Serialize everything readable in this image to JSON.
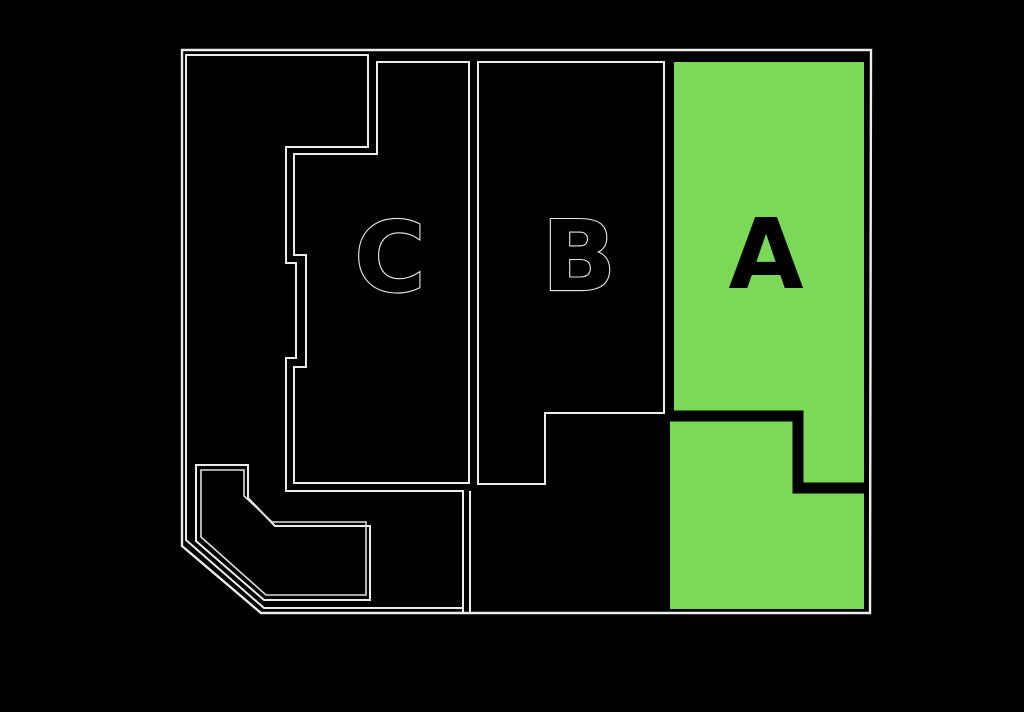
{
  "canvas": {
    "width": 1024,
    "height": 712,
    "background": "#000000"
  },
  "colors": {
    "background": "#000000",
    "line": "#ececec",
    "highlight": "#7bd957",
    "divider": "#000000",
    "label_fill": "#000000",
    "label_outline": "#e6e6e6"
  },
  "labels": [
    {
      "id": "section-c-label",
      "text": "C",
      "x": 390,
      "y": 291,
      "fontSize": 97,
      "fill": "#000000",
      "stroke": "#e6e6e6",
      "strokeWidth": 2.2
    },
    {
      "id": "section-b-label",
      "text": "B",
      "x": 579,
      "y": 290,
      "fontSize": 97,
      "fill": "#000000",
      "stroke": "#e6e6e6",
      "strokeWidth": 2.2
    },
    {
      "id": "section-a-label",
      "text": "A",
      "x": 766,
      "y": 288,
      "fontSize": 97,
      "fill": "#000000",
      "stroke": "none",
      "strokeWidth": 0
    }
  ],
  "shapes": [
    {
      "name": "section-a-highlight",
      "type": "polygon",
      "interactable": true,
      "points": [
        [
          674,
          62
        ],
        [
          864,
          62
        ],
        [
          864,
          609
        ],
        [
          670,
          609
        ],
        [
          670,
          418
        ],
        [
          674,
          418
        ]
      ],
      "fill": "#7bd957",
      "stroke": "none",
      "strokeWidth": 0
    },
    {
      "name": "section-a-divider-band",
      "type": "polyline",
      "interactable": false,
      "points": [
        [
          663,
          416
        ],
        [
          798,
          416
        ],
        [
          798,
          488
        ],
        [
          867,
          488
        ]
      ],
      "fill": "none",
      "stroke": "#000000",
      "strokeWidth": 11
    },
    {
      "name": "outer-boundary",
      "type": "polygon",
      "interactable": false,
      "points": [
        [
          182,
          50
        ],
        [
          871,
          50
        ],
        [
          870,
          613
        ],
        [
          261,
          613
        ],
        [
          182,
          546
        ]
      ],
      "fill": "none",
      "stroke": "#ececec",
      "strokeWidth": 2.4
    },
    {
      "name": "left-parcel-outline",
      "type": "polygon",
      "interactable": false,
      "points": [
        [
          186,
          55
        ],
        [
          368,
          55
        ],
        [
          368,
          147
        ],
        [
          286,
          147
        ],
        [
          286,
          263
        ],
        [
          296,
          263
        ],
        [
          296,
          358
        ],
        [
          286,
          358
        ],
        [
          286,
          491
        ],
        [
          463,
          491
        ],
        [
          463,
          608
        ],
        [
          264,
          608
        ],
        [
          186,
          540
        ]
      ],
      "fill": "none",
      "stroke": "#ececec",
      "strokeWidth": 2
    },
    {
      "name": "section-c-outline",
      "type": "polygon",
      "interactable": true,
      "points": [
        [
          377,
          62
        ],
        [
          469,
          62
        ],
        [
          469,
          483
        ],
        [
          294,
          483
        ],
        [
          294,
          367
        ],
        [
          306,
          367
        ],
        [
          306,
          255
        ],
        [
          294,
          255
        ],
        [
          294,
          154
        ],
        [
          377,
          154
        ]
      ],
      "fill": "none",
      "stroke": "#ececec",
      "strokeWidth": 2
    },
    {
      "name": "section-b-outline",
      "type": "polygon",
      "interactable": true,
      "points": [
        [
          478,
          62
        ],
        [
          664,
          62
        ],
        [
          664,
          413
        ],
        [
          545,
          413
        ],
        [
          545,
          484
        ],
        [
          478,
          484
        ]
      ],
      "fill": "none",
      "stroke": "#ececec",
      "strokeWidth": 2
    },
    {
      "name": "banner-parcel-outer-outline",
      "type": "polygon",
      "interactable": false,
      "points": [
        [
          196,
          465
        ],
        [
          248,
          465
        ],
        [
          248,
          498
        ],
        [
          275,
          526
        ],
        [
          370,
          526
        ],
        [
          370,
          600
        ],
        [
          264,
          600
        ],
        [
          196,
          541
        ]
      ],
      "fill": "none",
      "stroke": "#ececec",
      "strokeWidth": 2
    },
    {
      "name": "banner-parcel-inner-outline",
      "type": "polygon",
      "interactable": false,
      "points": [
        [
          201,
          470
        ],
        [
          244,
          470
        ],
        [
          244,
          496
        ],
        [
          272,
          522
        ],
        [
          366,
          522
        ],
        [
          366,
          595
        ],
        [
          266,
          595
        ],
        [
          201,
          537
        ]
      ],
      "fill": "none",
      "stroke": "#dedede",
      "strokeWidth": 1.6
    },
    {
      "name": "bottom-strip-divider-left",
      "type": "polyline",
      "interactable": false,
      "points": [
        [
          463,
          608
        ],
        [
          463,
          613
        ]
      ],
      "fill": "none",
      "stroke": "#ececec",
      "strokeWidth": 2
    },
    {
      "name": "bottom-strip-divider-right",
      "type": "polyline",
      "interactable": false,
      "points": [
        [
          470,
          491
        ],
        [
          470,
          613
        ]
      ],
      "fill": "none",
      "stroke": "#ececec",
      "strokeWidth": 2
    }
  ]
}
